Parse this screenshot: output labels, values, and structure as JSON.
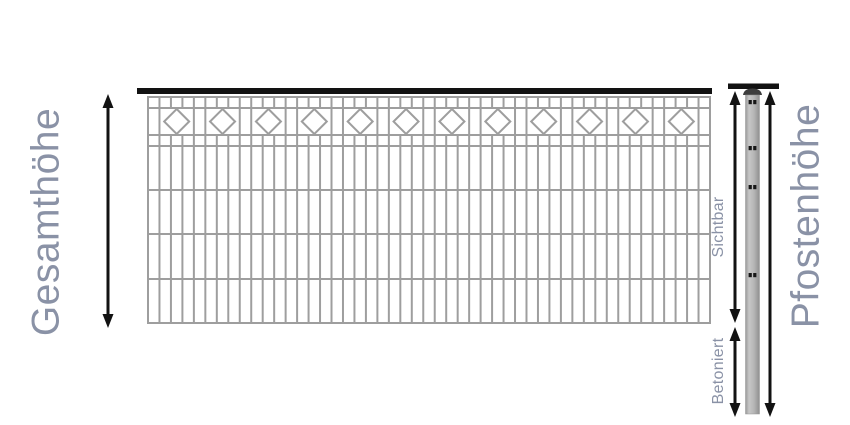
{
  "labels": {
    "total_height": "Gesamthöhe",
    "post_height": "Pfostenhöhe",
    "visible": "Sichtbar",
    "concreted": "Betoniert"
  },
  "fence": {
    "diamond_count": 12
  },
  "icons": {
    "total_height_arrow": "double-headed-vertical-arrow",
    "visible_arrow": "double-headed-vertical-arrow",
    "concreted_arrow": "double-headed-vertical-arrow",
    "post_height_arrow": "double-headed-vertical-arrow",
    "post_cap": "dome-post-cap",
    "post_holes": "mounting-hole-dots"
  },
  "colors": {
    "background": "#ffffff",
    "label_text": "#8a92a6",
    "wire": "#9e9e9e",
    "rail": "#121212",
    "arrow": "#121212",
    "post_body": "#b8b8b8",
    "post_body_edge": "#959595",
    "post_cap": "#3d3d3d",
    "hole_dot": "#161616"
  }
}
